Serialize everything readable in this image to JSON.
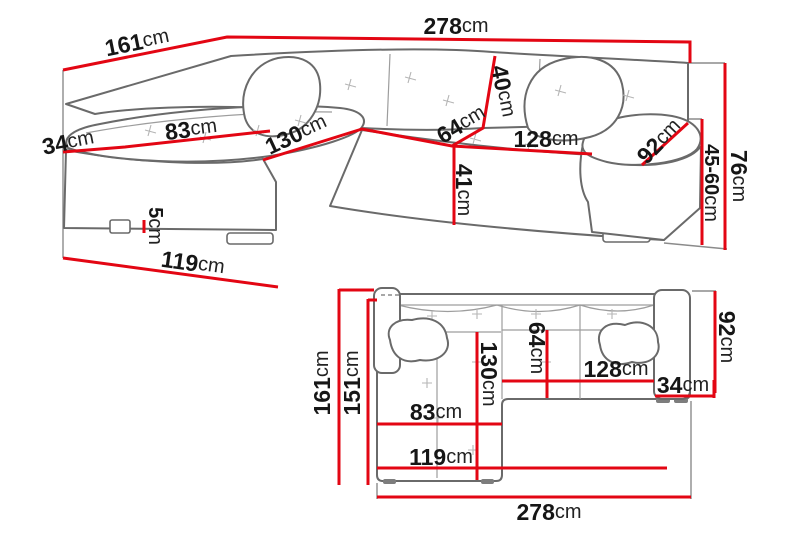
{
  "colors": {
    "dimension_red": "#e30613",
    "outline_gray": "#6a6a6a",
    "text_black": "#161616",
    "background": "#ffffff"
  },
  "views": {
    "perspective": {
      "dims": {
        "side_length": {
          "value": "161",
          "unit": "cm"
        },
        "total_width": {
          "value": "278",
          "unit": "cm"
        },
        "backrest_height": {
          "value": "40",
          "unit": "cm"
        },
        "seat_depth": {
          "value": "64",
          "unit": "cm"
        },
        "seat_width": {
          "value": "128",
          "unit": "cm"
        },
        "armrest_length": {
          "value": "92",
          "unit": "cm"
        },
        "seat_height": {
          "value": "41",
          "unit": "cm"
        },
        "armrest_width": {
          "value": "34",
          "unit": "cm"
        },
        "chaise_seat_width": {
          "value": "83",
          "unit": "cm"
        },
        "chaise_length": {
          "value": "130",
          "unit": "cm"
        },
        "leg_height": {
          "value": "5",
          "unit": "cm"
        },
        "chaise_depth": {
          "value": "119",
          "unit": "cm"
        },
        "total_height": {
          "value": "76",
          "unit": "cm"
        },
        "armrest_height": {
          "value": "45-60",
          "unit": "cm"
        }
      }
    },
    "plan": {
      "dims": {
        "side_length": {
          "value": "161",
          "unit": "cm"
        },
        "side_length_inner": {
          "value": "151",
          "unit": "cm"
        },
        "chaise_length": {
          "value": "130",
          "unit": "cm"
        },
        "seat_depth": {
          "value": "64",
          "unit": "cm"
        },
        "seat_width": {
          "value": "128",
          "unit": "cm"
        },
        "armrest_width": {
          "value": "34",
          "unit": "cm"
        },
        "armrest_depth": {
          "value": "92",
          "unit": "cm"
        },
        "chaise_seat_width": {
          "value": "83",
          "unit": "cm"
        },
        "chaise_width": {
          "value": "119",
          "unit": "cm"
        },
        "total_width": {
          "value": "278",
          "unit": "cm"
        }
      }
    }
  }
}
